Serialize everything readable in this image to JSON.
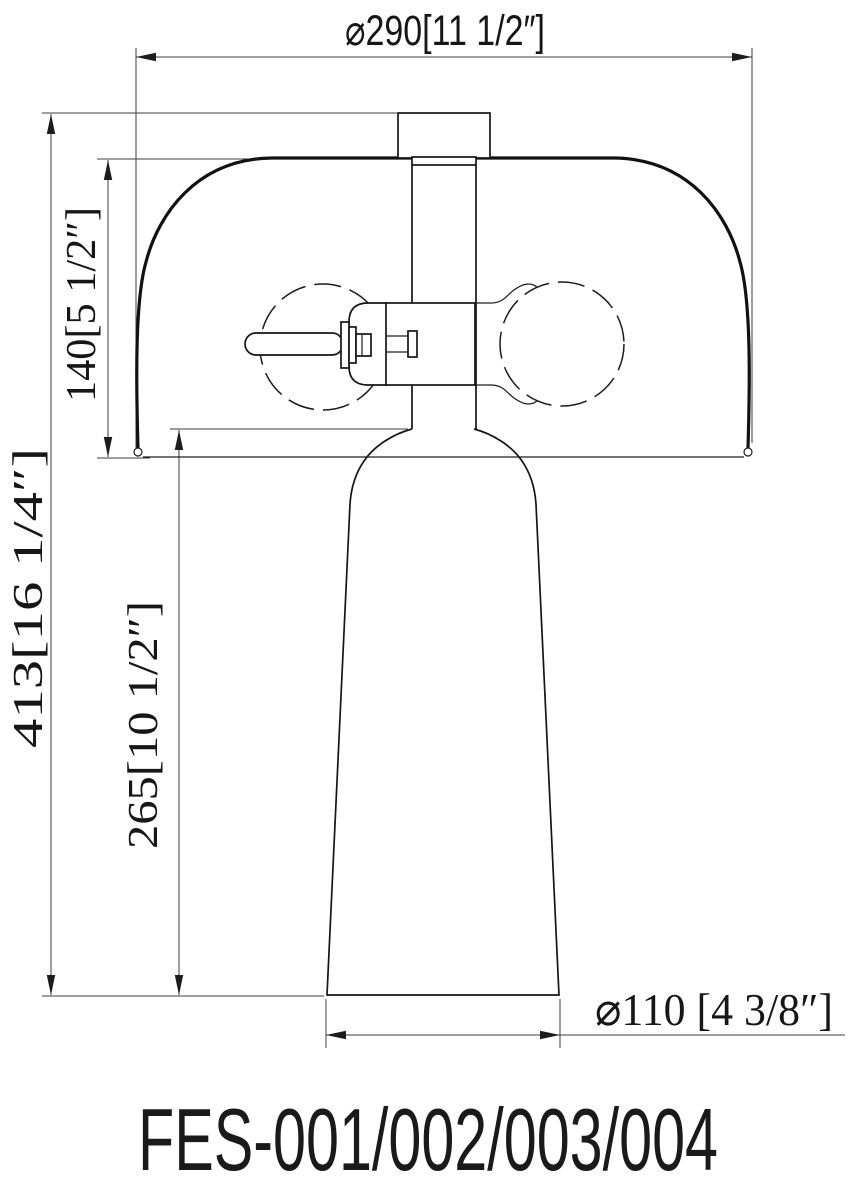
{
  "title": "FES-001/002/003/004",
  "dimensions": {
    "shade_diameter": {
      "label": "⌀290[11 1/2″]",
      "mm": "290",
      "inches": "11 1/2″"
    },
    "overall_height": {
      "label": "413[16 1/4″]",
      "mm": "413",
      "inches": "16 1/4″"
    },
    "shade_height": {
      "label": "140[5 1/2″]",
      "mm": "140",
      "inches": "5 1/2″"
    },
    "body_height": {
      "label": "265[10 1/2″]",
      "mm": "265",
      "inches": "10 1/2″"
    },
    "base_diameter": {
      "label": "⌀110 [4 3/8″]",
      "mm": "110",
      "inches": "4 3/8″"
    }
  }
}
